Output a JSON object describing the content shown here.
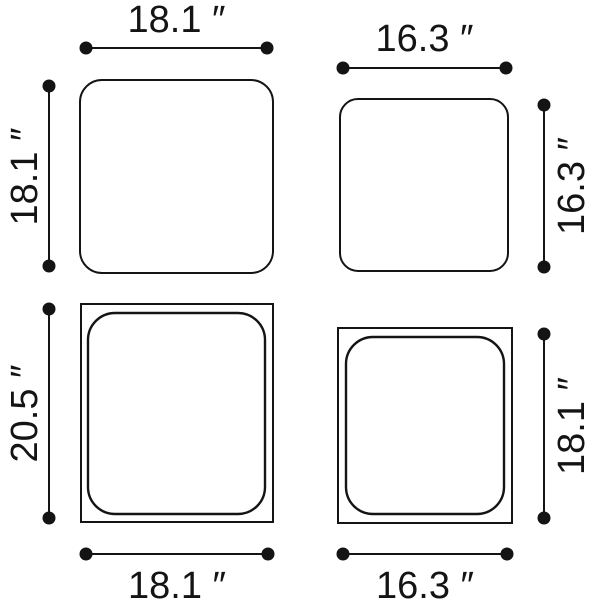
{
  "colors": {
    "ink": "#141414",
    "background": "#ffffff"
  },
  "panels": {
    "top_left": {
      "shape": "rounded-square",
      "width_in": 18.1,
      "height_in": 18.1,
      "width_label": "18.1 ″",
      "height_label": "18.1 ″"
    },
    "top_right": {
      "shape": "rounded-square",
      "width_in": 16.3,
      "height_in": 16.3,
      "width_label": "16.3 ″",
      "height_label": "16.3 ″"
    },
    "bottom_left": {
      "shape": "square-with-inset-cushion",
      "width_in": 18.1,
      "height_in": 20.5,
      "width_label": "18.1 ″",
      "height_label": "20.5 ″"
    },
    "bottom_right": {
      "shape": "square-with-inset-cushion",
      "width_in": 16.3,
      "height_in": 18.1,
      "width_label": "16.3 ″",
      "height_label": "18.1 ″"
    }
  }
}
